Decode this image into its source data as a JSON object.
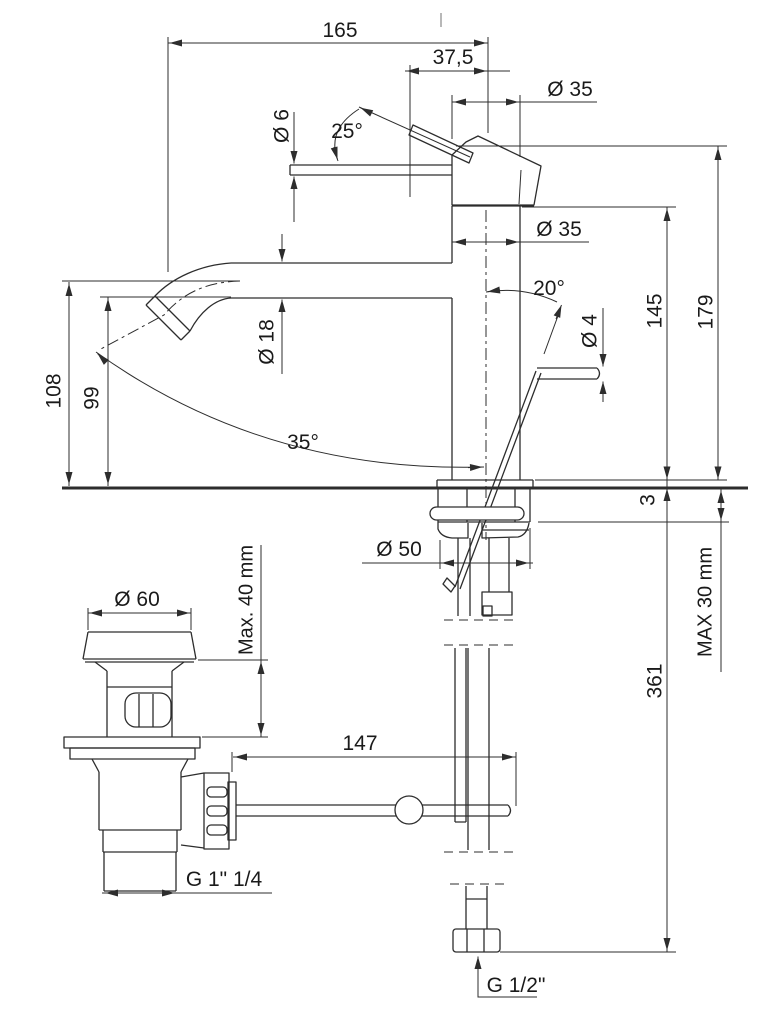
{
  "drawing": {
    "kind": "technical-dimension-drawing",
    "subject": "single-lever basin mixer faucet with pop-up waste and supply connection",
    "units": "mm",
    "palette": {
      "line": "#2d2d2d",
      "text": "#1a1a1a",
      "background": "#ffffff",
      "tick": "#b8b8b8"
    }
  },
  "dims": {
    "reach": "165",
    "lever_reach": "37,5",
    "head_dia": "Ø 35",
    "body_dia": "Ø 35",
    "lever_dia": "Ø 6",
    "lever_angle": "25°",
    "spout_dia": "Ø 18",
    "rod_angle": "20°",
    "rod_dia": "Ø 4",
    "h_spout": "145",
    "h_total": "179",
    "h_axis": "108",
    "h_under_spout": "99",
    "swivel": "35°",
    "plate": "3",
    "base_dia": "Ø 50",
    "counter_max": "MAX 30 mm",
    "h_below": "361",
    "waste_dia": "Ø 60",
    "deck_max": "Max. 40 mm",
    "linkage": "147",
    "waste_thread": "G 1\" 1/4",
    "inlet_thread": "G 1/2\""
  }
}
